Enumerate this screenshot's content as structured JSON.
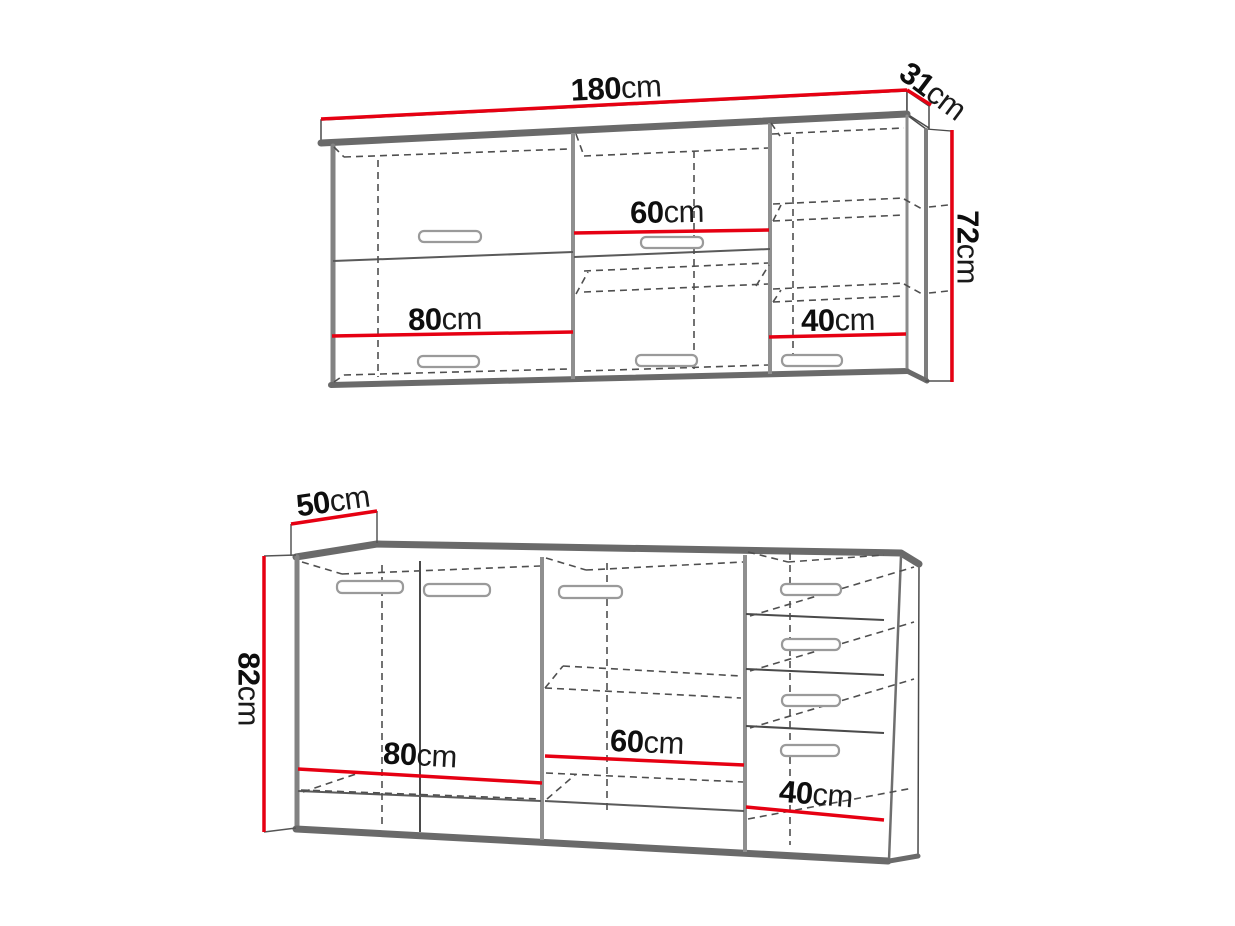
{
  "colors": {
    "dimension_red": "#e60012",
    "outline_gray": "#7d7d7d",
    "band_gray": "#6a6a6a",
    "sketch_dark": "#4a4a4a",
    "background": "#ffffff"
  },
  "wall_cabinet": {
    "name": "wall cabinet (upper unit)",
    "width": {
      "value": "180",
      "unit": "cm"
    },
    "depth": {
      "value": "31",
      "unit": "cm"
    },
    "height": {
      "value": "72",
      "unit": "cm"
    },
    "section_widths": [
      {
        "value": "80",
        "unit": "cm"
      },
      {
        "value": "60",
        "unit": "cm"
      },
      {
        "value": "40",
        "unit": "cm"
      }
    ]
  },
  "base_cabinet": {
    "name": "base cabinet (lower unit)",
    "depth": {
      "value": "50",
      "unit": "cm"
    },
    "height": {
      "value": "82",
      "unit": "cm"
    },
    "section_widths": [
      {
        "value": "80",
        "unit": "cm"
      },
      {
        "value": "60",
        "unit": "cm"
      },
      {
        "value": "40",
        "unit": "cm"
      }
    ]
  }
}
